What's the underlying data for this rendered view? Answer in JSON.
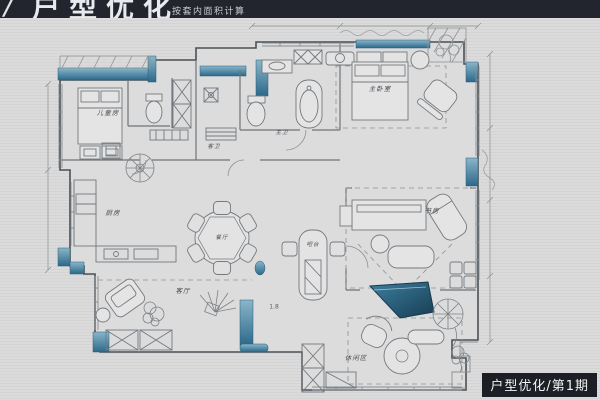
{
  "header": {
    "logo_mark": "/",
    "title": "户型优化",
    "subtitle": "按套内面积计算"
  },
  "badge": {
    "text": "户型优化/第1期"
  },
  "rooms": {
    "kids": {
      "label": "儿童房"
    },
    "guest_bath": {
      "label": "客卫"
    },
    "master_bath": {
      "label": "主卫"
    },
    "master_bedroom": {
      "label": "主卧室"
    },
    "kitchen": {
      "label": "厨房"
    },
    "dining": {
      "label": "餐厅"
    },
    "bar": {
      "label": "吧台"
    },
    "study": {
      "label": "书房"
    },
    "living": {
      "label": "客厅"
    },
    "leisure": {
      "label": "休闲区"
    }
  },
  "annotations": {
    "height_note": "1.8"
  },
  "colors": {
    "background": "#d9d9d9",
    "header_bg": "#22242e",
    "wall_teal": "#2f6b8c",
    "wall_teal_light": "#7fb3c8",
    "piano_teal_dark": "#173d52",
    "ink": "#4a4f55",
    "badge_bg": "#1d1f27"
  }
}
